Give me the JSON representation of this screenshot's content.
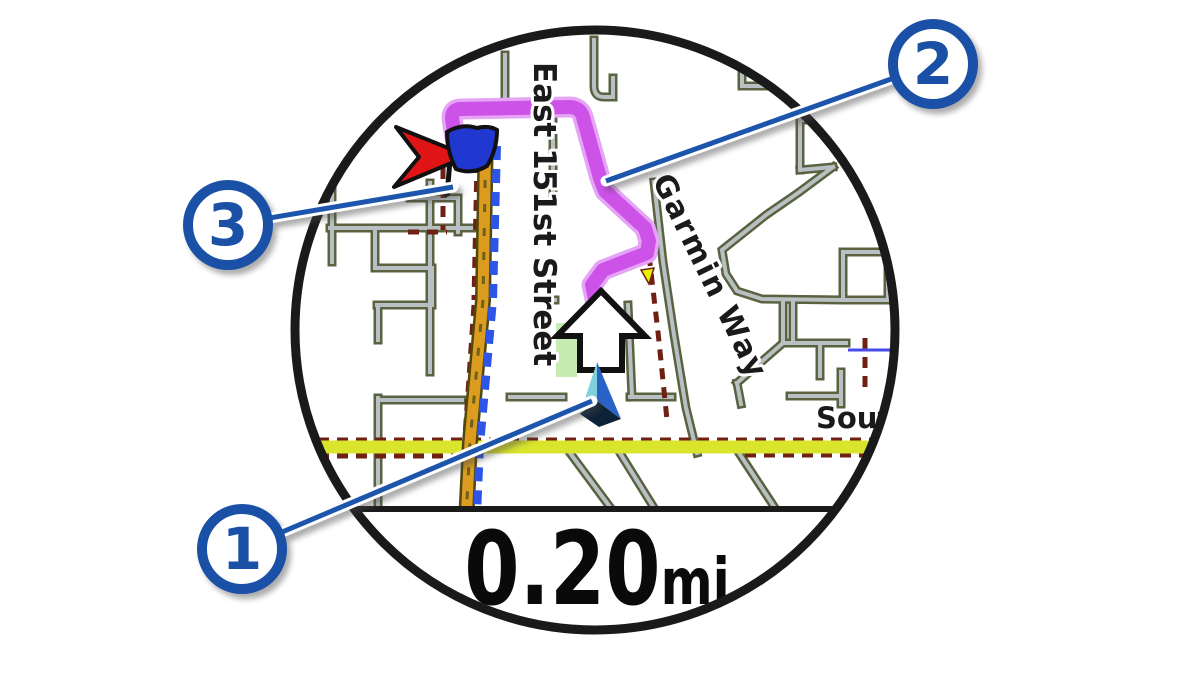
{
  "illustration": {
    "kind": "watch-navigation-map",
    "distance": {
      "value": "0.20",
      "unit": "mi"
    },
    "map": {
      "street_labels": {
        "east_151st": "East 151st Street",
        "garmin_way": "Garmin Way",
        "south_truncated": "Sout"
      },
      "icons": [
        "destination-flag-icon",
        "direction-arrow-icon",
        "position-marker-icon",
        "route-line"
      ],
      "colors": {
        "route": "#cc52e8",
        "highway_orange": "#dc9c20",
        "navigation_dash_blue": "#2d55e8",
        "secondary_road_yellow": "#d9e52c",
        "minor_road_fill": "#b9c0c3",
        "minor_road_casing": "#5a6240",
        "boundary_dash_maroon": "#6e2113",
        "park_green": "#c6ecb4",
        "flag_red": "#e01414",
        "flag_blue": "#2038d0"
      }
    },
    "callouts": [
      {
        "number": "1",
        "target": "position-marker"
      },
      {
        "number": "2",
        "target": "route-line"
      },
      {
        "number": "3",
        "target": "destination-marker"
      }
    ],
    "accent_color": "#1a50a6"
  }
}
